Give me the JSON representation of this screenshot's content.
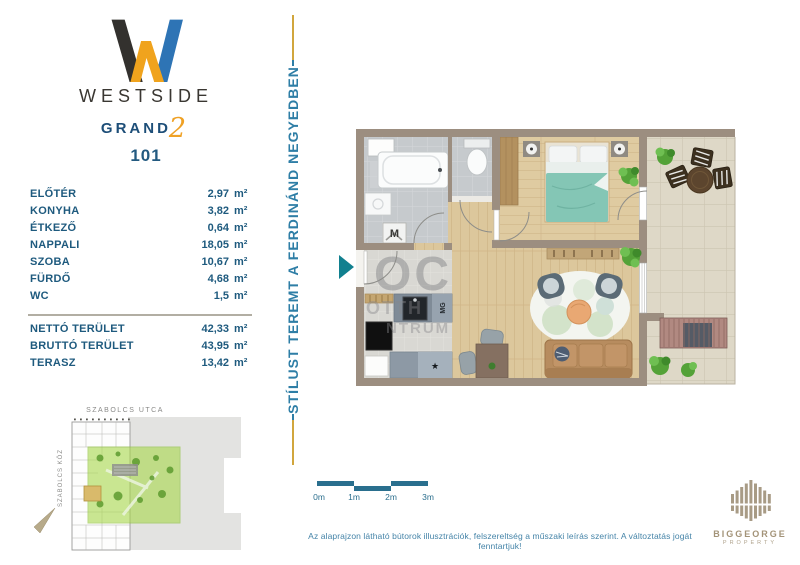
{
  "brand": {
    "name": "WESTSIDE",
    "line2": "GRAND",
    "line2_suffix": "2",
    "unit_number": "101"
  },
  "areas": {
    "rooms": [
      {
        "label": "ELŐTÉR",
        "value": "2,97",
        "unit": "m²"
      },
      {
        "label": "KONYHA",
        "value": "3,82",
        "unit": "m²"
      },
      {
        "label": "ÉTKEZŐ",
        "value": "0,64",
        "unit": "m²"
      },
      {
        "label": "NAPPALI",
        "value": "18,05",
        "unit": "m²"
      },
      {
        "label": "SZOBA",
        "value": "10,67",
        "unit": "m²"
      },
      {
        "label": "FÜRDŐ",
        "value": "4,68",
        "unit": "m²"
      },
      {
        "label": "WC",
        "value": "1,5",
        "unit": "m²"
      }
    ],
    "totals": [
      {
        "label": "NETTÓ TERÜLET",
        "value": "42,33",
        "unit": "m²",
        "bold": false
      },
      {
        "label": "BRUTTÓ TERÜLET",
        "value": "43,95",
        "unit": "m²",
        "bold": true
      },
      {
        "label": "TERASZ",
        "value": "13,42",
        "unit": "m²",
        "bold": false
      }
    ]
  },
  "tagline": "STÍLUST TEREMT A FERDINÁND NEGYEDBEN",
  "floorplan": {
    "watermark": {
      "line1": "OC",
      "line2": "OTTH",
      "line3": "NTRUM"
    },
    "labels": {
      "washing_machine": "M",
      "dishwasher": "MG",
      "fridge_star": "★"
    }
  },
  "scalebar": {
    "ticks": [
      "0m",
      "1m",
      "2m",
      "3m"
    ]
  },
  "sitemap": {
    "street_top": "SZABOLCS UTCA",
    "street_left": "SZABOLCS KÖZ"
  },
  "disclaimer": "Az alaprajzon látható bútorok illusztrációk, felszereltség a műszaki leírás szerint. A változtatás jogát fenntartjuk!",
  "developer": {
    "name": "BIGGEORGE",
    "subtitle": "PROPERTY"
  },
  "colors": {
    "navy": "#1d4e78",
    "gold": "#d1a63d",
    "teal_text": "#2e7ea6",
    "orange": "#efa125",
    "logo_blue": "#2e74b5",
    "wall": "#9c8e80",
    "entry_arrow": "#11808f",
    "developer_taupe": "#a89b85"
  }
}
